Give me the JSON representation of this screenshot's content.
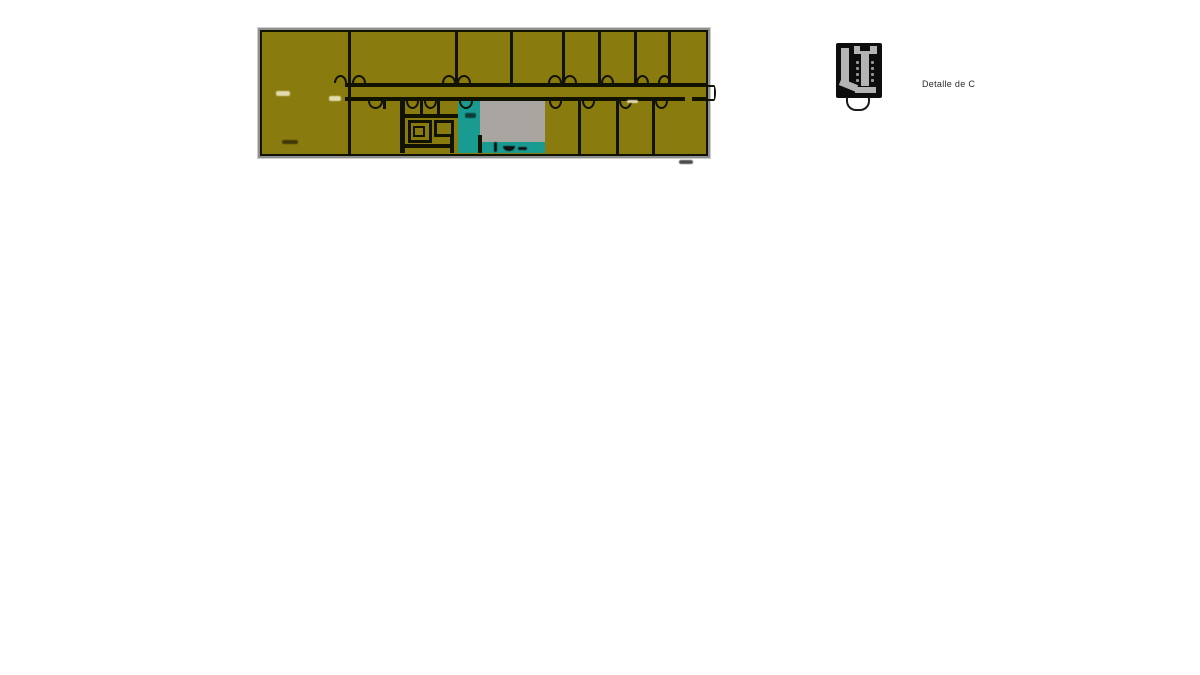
{
  "canvas": {
    "width": 1200,
    "height": 675,
    "background": "#ffffff"
  },
  "floor_plan": {
    "description": "scanned CAD floor plan, long rectangular building with central corridor, door swing arcs, wet-core cluster, teal service zone and gray patio void",
    "colors": {
      "room_fill": "#8a7b0e",
      "wet_area_fill": "#1a9b92",
      "patio_fill": "#a9a6a1",
      "wall": "#121200",
      "frame": "#8f8f8f"
    }
  },
  "detail_callout": {
    "label": "Detalle de C",
    "icon": "wall-phone-detail-icon",
    "colors": {
      "body": "#0d0d0d",
      "hardware": "#b4b4b4"
    }
  }
}
